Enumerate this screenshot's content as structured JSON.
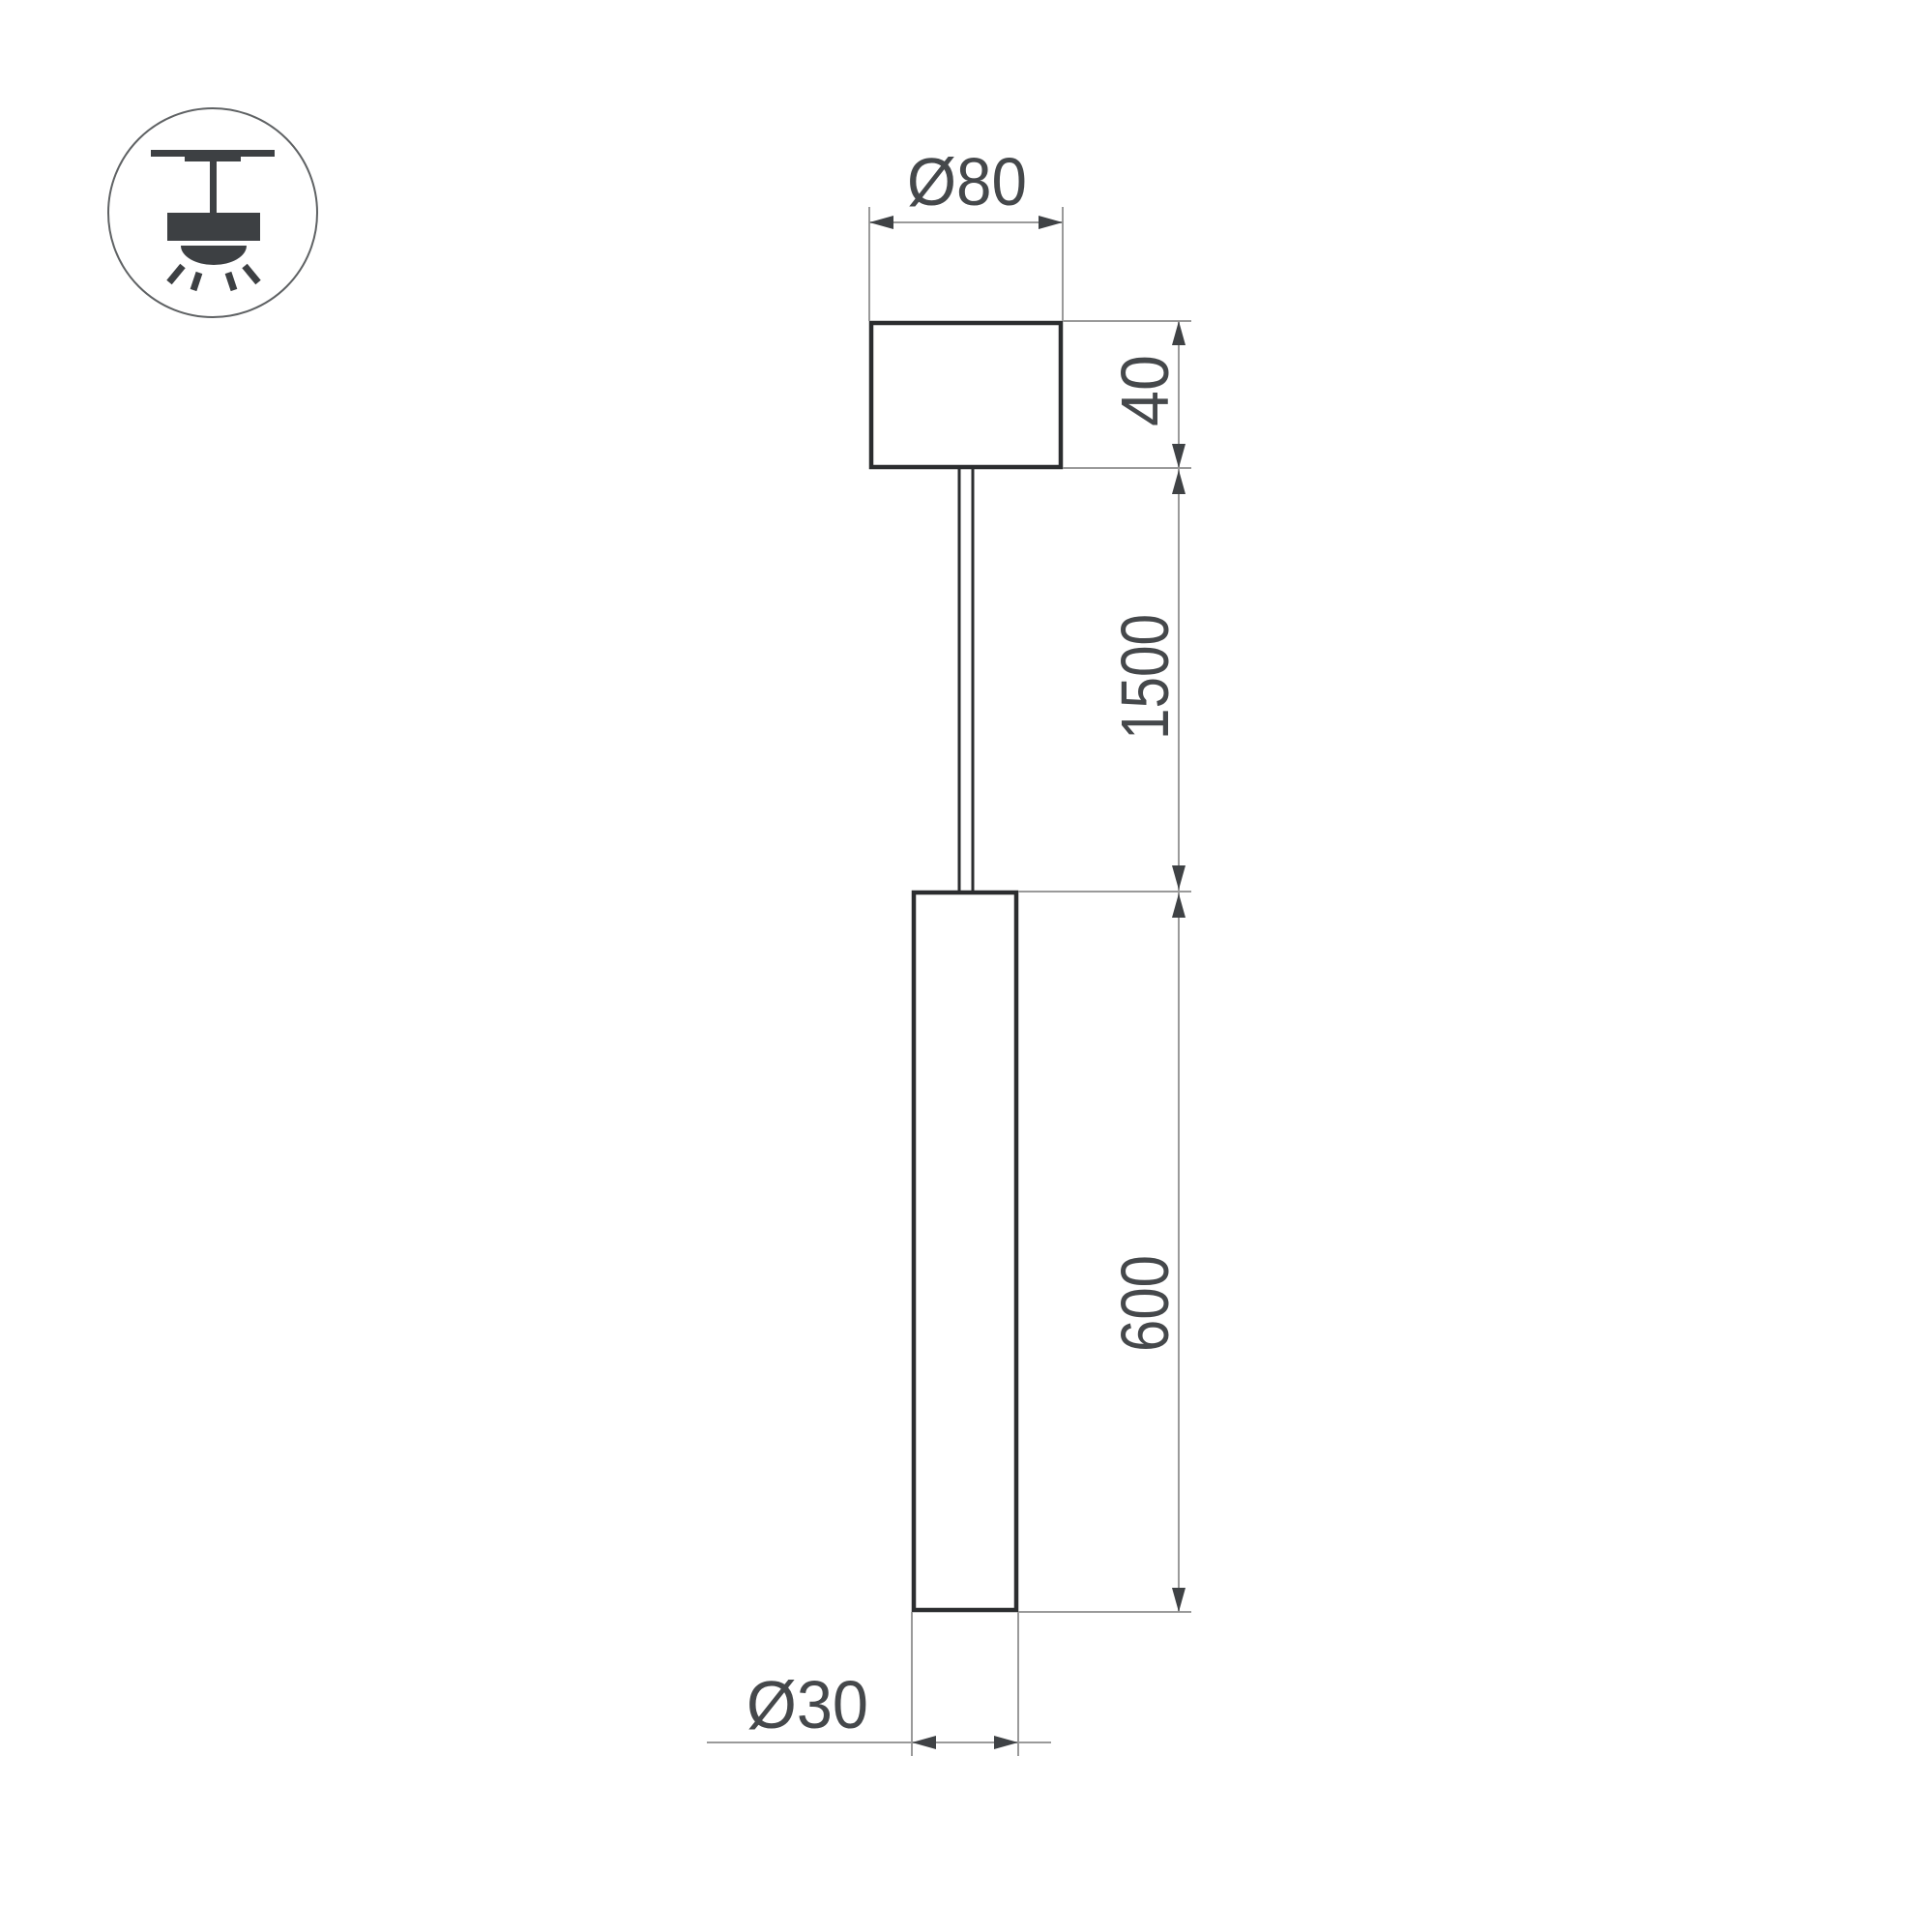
{
  "icon": {
    "name": "pendant-light-ceiling-mount-icon"
  },
  "dimensions": {
    "canopy_diameter_label": "Ø80",
    "canopy_height_label": "40",
    "suspension_length_label": "1500",
    "tube_length_label": "600",
    "tube_diameter_label": "Ø30"
  },
  "colors": {
    "background": "#ffffff",
    "object_stroke": "#2b2d2f",
    "thin_line": "#9a9a9a",
    "arrow": "#3f4245",
    "text": "#45484b",
    "icon_fill": "#3d4043",
    "icon_circle_stroke": "#5f6264"
  }
}
